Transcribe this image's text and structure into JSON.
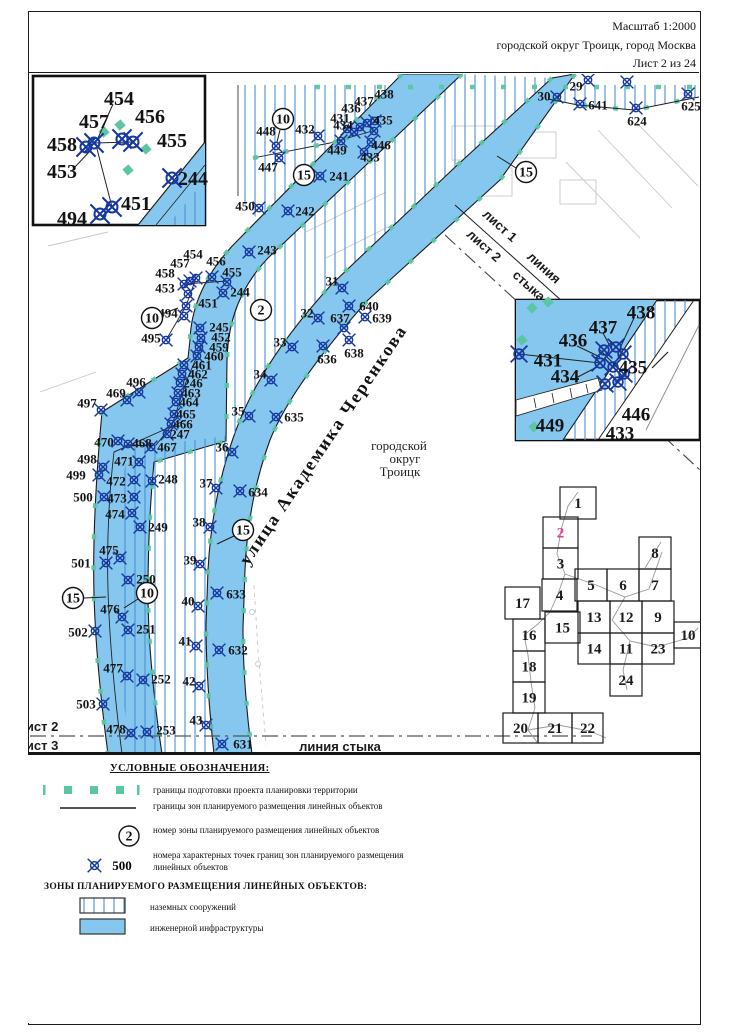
{
  "header": {
    "scale": "Масштаб 1:2000",
    "region": "городской округ Троицк, город Москва",
    "sheet": "Лист 2 из 24"
  },
  "map": {
    "labels": [
      {
        "name": "street-label",
        "t": "улица Академика Черенкова",
        "x": 328,
        "y": 448,
        "rot": -56,
        "cls": "street"
      },
      {
        "name": "city-label-line1",
        "t": "городской",
        "x": 399,
        "y": 450,
        "cls": "city"
      },
      {
        "name": "city-label-line2",
        "t": "округ",
        "x": 405,
        "y": 463,
        "cls": "city"
      },
      {
        "name": "city-label-line3",
        "t": "Троицк",
        "x": 400,
        "y": 476,
        "cls": "city"
      },
      {
        "name": "join-top-sheet1",
        "t": "лист 1",
        "x": 497,
        "y": 229,
        "rot": 42,
        "cls": "join"
      },
      {
        "name": "join-top-sheet2",
        "t": "лист 2",
        "x": 481,
        "y": 249,
        "rot": 42,
        "cls": "join"
      },
      {
        "name": "join-top-word1",
        "t": "линия",
        "x": 541,
        "y": 271,
        "rot": 42,
        "cls": "join"
      },
      {
        "name": "join-top-word2",
        "t": "стыка",
        "x": 526,
        "y": 289,
        "rot": 42,
        "cls": "join"
      },
      {
        "name": "join-bottom-sheet2",
        "t": "лист 2",
        "x": 38,
        "y": 731,
        "cls": "join",
        "anchor": "start"
      },
      {
        "name": "join-bottom-sheet3",
        "t": "лист 3",
        "x": 38,
        "y": 750,
        "cls": "join",
        "anchor": "start"
      },
      {
        "name": "join-bottom-line-label",
        "t": "линия стыка",
        "x": 340,
        "y": 751,
        "cls": "join"
      },
      {
        "name": "ghost-label",
        "t": "3/стр.3",
        "x": 657,
        "y": 394,
        "rot": -50,
        "cls": "ghost"
      }
    ],
    "zone_circles": [
      {
        "n": "10",
        "x": 283,
        "y": 119,
        "leader": [
          280,
          130,
          277,
          142
        ]
      },
      {
        "n": "15",
        "x": 304,
        "y": 175
      },
      {
        "n": "15",
        "x": 526,
        "y": 172,
        "leader": [
          516,
          168,
          497,
          156
        ]
      },
      {
        "n": "2",
        "x": 261,
        "y": 310
      },
      {
        "n": "10",
        "x": 152,
        "y": 318,
        "leader": [
          162,
          314,
          178,
          308
        ]
      },
      {
        "n": "15",
        "x": 243,
        "y": 530,
        "leader": [
          234,
          536,
          217,
          544
        ]
      },
      {
        "n": "10",
        "x": 147,
        "y": 593,
        "leader": [
          138,
          599,
          124,
          608
        ]
      },
      {
        "n": "15",
        "x": 73,
        "y": 598,
        "leader": [
          84,
          598,
          106,
          597
        ]
      }
    ],
    "points": [
      {
        "n": "448",
        "mx": 276,
        "my": 146,
        "lx": 266,
        "ly": 131
      },
      {
        "n": "447",
        "mx": 279,
        "my": 158,
        "lx": 268,
        "ly": 167
      },
      {
        "n": "432",
        "mx": 318,
        "my": 136,
        "lx": 305,
        "ly": 129
      },
      {
        "n": "431",
        "mx": 347,
        "my": 129,
        "lx": 340,
        "ly": 118
      },
      {
        "n": "436",
        "mx": 360,
        "my": 127,
        "lx": 351,
        "ly": 108
      },
      {
        "n": "437",
        "mx": 367,
        "my": 123,
        "lx": 364,
        "ly": 101
      },
      {
        "n": "438",
        "mx": 375,
        "my": 121,
        "lx": 384,
        "ly": 94
      },
      {
        "n": "434",
        "mx": 354,
        "my": 132,
        "lx": 343,
        "ly": 125
      },
      {
        "n": "435",
        "mx": 374,
        "my": 131,
        "lx": 383,
        "ly": 120
      },
      {
        "n": "449",
        "mx": 341,
        "my": 141,
        "lx": 337,
        "ly": 150
      },
      {
        "n": "446",
        "mx": 371,
        "my": 142,
        "lx": 381,
        "ly": 145
      },
      {
        "n": "433",
        "mx": 364,
        "my": 152,
        "lx": 370,
        "ly": 157
      },
      {
        "n": "241",
        "mx": 320,
        "my": 176,
        "lx": 339,
        "ly": 176
      },
      {
        "n": "450",
        "mx": 259,
        "my": 208,
        "lx": 245,
        "ly": 206
      },
      {
        "n": "242",
        "mx": 288,
        "my": 211,
        "lx": 305,
        "ly": 211
      },
      {
        "n": "243",
        "mx": 249,
        "my": 252,
        "lx": 267,
        "ly": 250
      },
      {
        "n": "244",
        "mx": 223,
        "my": 293,
        "lx": 240,
        "ly": 292
      },
      {
        "n": "454",
        "mx": 196,
        "my": 278,
        "lx": 193,
        "ly": 254
      },
      {
        "n": "457",
        "mx": 190,
        "my": 281,
        "lx": 180,
        "ly": 263
      },
      {
        "n": "456",
        "mx": 212,
        "my": 277,
        "lx": 216,
        "ly": 261
      },
      {
        "n": "458",
        "mx": 184,
        "my": 284,
        "lx": 165,
        "ly": 273
      },
      {
        "n": "455",
        "mx": 227,
        "my": 282,
        "lx": 232,
        "ly": 272
      },
      {
        "n": "453",
        "mx": 188,
        "my": 294,
        "lx": 165,
        "ly": 288
      },
      {
        "n": "451",
        "mx": 186,
        "my": 306,
        "lx": 208,
        "ly": 303
      },
      {
        "n": "494",
        "mx": 184,
        "my": 316,
        "lx": 168,
        "ly": 313
      },
      {
        "n": "495",
        "mx": 166,
        "my": 340,
        "lx": 151,
        "ly": 338
      },
      {
        "n": "245",
        "mx": 200,
        "my": 328,
        "lx": 219,
        "ly": 327
      },
      {
        "n": "452",
        "mx": 201,
        "my": 338,
        "lx": 221,
        "ly": 337
      },
      {
        "n": "459",
        "mx": 199,
        "my": 347,
        "lx": 219,
        "ly": 347
      },
      {
        "n": "460",
        "mx": 197,
        "my": 356,
        "lx": 214,
        "ly": 356
      },
      {
        "n": "461",
        "mx": 184,
        "my": 365,
        "lx": 202,
        "ly": 365
      },
      {
        "n": "462",
        "mx": 182,
        "my": 374,
        "lx": 198,
        "ly": 374
      },
      {
        "n": "246",
        "mx": 180,
        "my": 383,
        "lx": 193,
        "ly": 383
      },
      {
        "n": "463",
        "mx": 178,
        "my": 393,
        "lx": 191,
        "ly": 393
      },
      {
        "n": "464",
        "mx": 176,
        "my": 402,
        "lx": 189,
        "ly": 402
      },
      {
        "n": "465",
        "mx": 174,
        "my": 414,
        "lx": 186,
        "ly": 414
      },
      {
        "n": "466",
        "mx": 171,
        "my": 424,
        "lx": 183,
        "ly": 424
      },
      {
        "n": "247",
        "mx": 167,
        "my": 434,
        "lx": 180,
        "ly": 434
      },
      {
        "n": "467",
        "mx": 151,
        "my": 447,
        "lx": 167,
        "ly": 447
      },
      {
        "n": "468",
        "mx": 128,
        "my": 444,
        "lx": 142,
        "ly": 443
      },
      {
        "n": "470",
        "mx": 118,
        "my": 441,
        "lx": 104,
        "ly": 442
      },
      {
        "n": "496",
        "mx": 139,
        "my": 392,
        "lx": 136,
        "ly": 382
      },
      {
        "n": "469",
        "mx": 127,
        "my": 400,
        "lx": 116,
        "ly": 393
      },
      {
        "n": "497",
        "mx": 101,
        "my": 410,
        "lx": 87,
        "ly": 403
      },
      {
        "n": "498",
        "mx": 103,
        "my": 467,
        "lx": 87,
        "ly": 459
      },
      {
        "n": "471",
        "mx": 139,
        "my": 462,
        "lx": 124,
        "ly": 461
      },
      {
        "n": "499",
        "mx": 99,
        "my": 475,
        "lx": 76,
        "ly": 475
      },
      {
        "n": "472",
        "mx": 134,
        "my": 480,
        "lx": 116,
        "ly": 481
      },
      {
        "n": "248",
        "mx": 152,
        "my": 481,
        "lx": 168,
        "ly": 479
      },
      {
        "n": "500",
        "mx": 104,
        "my": 497,
        "lx": 83,
        "ly": 497
      },
      {
        "n": "473",
        "mx": 134,
        "my": 497,
        "lx": 117,
        "ly": 498
      },
      {
        "n": "474",
        "mx": 132,
        "my": 513,
        "lx": 115,
        "ly": 514
      },
      {
        "n": "249",
        "mx": 140,
        "my": 527,
        "lx": 158,
        "ly": 527
      },
      {
        "n": "501",
        "mx": 106,
        "my": 563,
        "lx": 81,
        "ly": 563
      },
      {
        "n": "475",
        "mx": 120,
        "my": 558,
        "lx": 109,
        "ly": 550
      },
      {
        "n": "250",
        "mx": 128,
        "my": 580,
        "lx": 146,
        "ly": 579
      },
      {
        "n": "476",
        "mx": 122,
        "my": 617,
        "lx": 110,
        "ly": 609
      },
      {
        "n": "502",
        "mx": 95,
        "my": 631,
        "lx": 78,
        "ly": 632
      },
      {
        "n": "251",
        "mx": 128,
        "my": 630,
        "lx": 146,
        "ly": 629
      },
      {
        "n": "477",
        "mx": 127,
        "my": 676,
        "lx": 113,
        "ly": 668
      },
      {
        "n": "252",
        "mx": 143,
        "my": 680,
        "lx": 161,
        "ly": 679
      },
      {
        "n": "503",
        "mx": 103,
        "my": 704,
        "lx": 86,
        "ly": 704
      },
      {
        "n": "478",
        "mx": 131,
        "my": 733,
        "lx": 116,
        "ly": 729
      },
      {
        "n": "253",
        "mx": 147,
        "my": 732,
        "lx": 166,
        "ly": 730
      },
      {
        "n": "31",
        "mx": 342,
        "my": 288,
        "lx": 332,
        "ly": 281
      },
      {
        "n": "32",
        "mx": 318,
        "my": 318,
        "lx": 307,
        "ly": 313
      },
      {
        "n": "33",
        "mx": 292,
        "my": 347,
        "lx": 280,
        "ly": 342
      },
      {
        "n": "34",
        "mx": 271,
        "my": 380,
        "lx": 260,
        "ly": 374
      },
      {
        "n": "35",
        "mx": 249,
        "my": 416,
        "lx": 238,
        "ly": 411
      },
      {
        "n": "36",
        "mx": 232,
        "my": 452,
        "lx": 222,
        "ly": 447
      },
      {
        "n": "37",
        "mx": 216,
        "my": 488,
        "lx": 206,
        "ly": 483
      },
      {
        "n": "38",
        "mx": 210,
        "my": 527,
        "lx": 199,
        "ly": 522
      },
      {
        "n": "39",
        "mx": 200,
        "my": 564,
        "lx": 190,
        "ly": 560
      },
      {
        "n": "40",
        "mx": 198,
        "my": 606,
        "lx": 188,
        "ly": 601
      },
      {
        "n": "41",
        "mx": 196,
        "my": 646,
        "lx": 185,
        "ly": 641
      },
      {
        "n": "42",
        "mx": 199,
        "my": 686,
        "lx": 189,
        "ly": 681
      },
      {
        "n": "43",
        "mx": 206,
        "my": 725,
        "lx": 196,
        "ly": 720
      },
      {
        "n": "640",
        "mx": 349,
        "my": 306,
        "lx": 369,
        "ly": 306
      },
      {
        "n": "639",
        "mx": 365,
        "my": 317,
        "lx": 382,
        "ly": 318
      },
      {
        "n": "637",
        "mx": 344,
        "my": 328,
        "lx": 340,
        "ly": 318
      },
      {
        "n": "638",
        "mx": 349,
        "my": 340,
        "lx": 354,
        "ly": 353
      },
      {
        "n": "636",
        "mx": 323,
        "my": 346,
        "lx": 327,
        "ly": 359
      },
      {
        "n": "635",
        "mx": 276,
        "my": 417,
        "lx": 294,
        "ly": 417
      },
      {
        "n": "634",
        "mx": 240,
        "my": 491,
        "lx": 258,
        "ly": 492
      },
      {
        "n": "633",
        "mx": 217,
        "my": 593,
        "lx": 236,
        "ly": 594
      },
      {
        "n": "632",
        "mx": 219,
        "my": 650,
        "lx": 238,
        "ly": 650
      },
      {
        "n": "631",
        "mx": 222,
        "my": 744,
        "lx": 243,
        "ly": 744
      },
      {
        "n": "29",
        "mx": 588,
        "my": 80,
        "lx": 576,
        "ly": 86
      },
      {
        "n": "30",
        "mx": 557,
        "my": 97,
        "lx": 544,
        "ly": 96
      },
      {
        "n": "641",
        "mx": 580,
        "my": 104,
        "lx": 598,
        "ly": 105
      },
      {
        "n": "624",
        "mx": 636,
        "my": 108,
        "lx": 637,
        "ly": 121
      },
      {
        "n": "625",
        "mx": 688,
        "my": 94,
        "lx": 691,
        "ly": 106
      }
    ],
    "extra_markers": [
      [
        627,
        82
      ]
    ],
    "inset1": {
      "labels": [
        {
          "n": "454",
          "x": 119,
          "y": 98
        },
        {
          "n": "457",
          "x": 94,
          "y": 121
        },
        {
          "n": "456",
          "x": 150,
          "y": 116
        },
        {
          "n": "458",
          "x": 62,
          "y": 144
        },
        {
          "n": "455",
          "x": 172,
          "y": 140
        },
        {
          "n": "453",
          "x": 62,
          "y": 171
        },
        {
          "n": "244",
          "x": 193,
          "y": 178
        },
        {
          "n": "451",
          "x": 136,
          "y": 203
        },
        {
          "n": "494",
          "x": 72,
          "y": 218
        }
      ],
      "markers": [
        [
          94,
          143
        ],
        [
          86,
          147
        ],
        [
          122,
          139
        ],
        [
          133,
          142
        ],
        [
          172,
          178
        ],
        [
          112,
          207
        ],
        [
          100,
          214
        ]
      ]
    },
    "inset2": {
      "labels": [
        {
          "n": "438",
          "x": 641,
          "y": 312
        },
        {
          "n": "437",
          "x": 603,
          "y": 327
        },
        {
          "n": "436",
          "x": 573,
          "y": 340
        },
        {
          "n": "431",
          "x": 548,
          "y": 360
        },
        {
          "n": "434",
          "x": 565,
          "y": 376
        },
        {
          "n": "435",
          "x": 633,
          "y": 367
        },
        {
          "n": "446",
          "x": 636,
          "y": 414
        },
        {
          "n": "449",
          "x": 550,
          "y": 425
        },
        {
          "n": "433",
          "x": 620,
          "y": 433
        }
      ],
      "markers": [
        [
          604,
          350
        ],
        [
          616,
          347
        ],
        [
          623,
          354
        ],
        [
          600,
          363
        ],
        [
          613,
          367
        ],
        [
          624,
          374
        ],
        [
          605,
          384
        ],
        [
          618,
          382
        ],
        [
          519,
          354
        ]
      ]
    },
    "index": {
      "cells": [
        {
          "n": "1",
          "x": 560,
          "y": 487,
          "w": 36,
          "h": 32
        },
        {
          "n": "2",
          "x": 543,
          "y": 517,
          "w": 35,
          "h": 31,
          "cur": true
        },
        {
          "n": "3",
          "x": 543,
          "y": 548,
          "w": 35,
          "h": 31
        },
        {
          "n": "4",
          "x": 542,
          "y": 579,
          "w": 35,
          "h": 32
        },
        {
          "n": "5",
          "x": 575,
          "y": 569,
          "w": 32,
          "h": 32
        },
        {
          "n": "6",
          "x": 607,
          "y": 569,
          "w": 32,
          "h": 32
        },
        {
          "n": "8",
          "x": 639,
          "y": 537,
          "w": 32,
          "h": 32
        },
        {
          "n": "7",
          "x": 639,
          "y": 569,
          "w": 32,
          "h": 32
        },
        {
          "n": "17",
          "x": 505,
          "y": 587,
          "w": 35,
          "h": 32
        },
        {
          "n": "15",
          "x": 545,
          "y": 612,
          "w": 35,
          "h": 31
        },
        {
          "n": "13",
          "x": 578,
          "y": 601,
          "w": 32,
          "h": 32
        },
        {
          "n": "12",
          "x": 610,
          "y": 601,
          "w": 32,
          "h": 32
        },
        {
          "n": "9",
          "x": 642,
          "y": 601,
          "w": 32,
          "h": 32
        },
        {
          "n": "16",
          "x": 513,
          "y": 619,
          "w": 32,
          "h": 32
        },
        {
          "n": "10",
          "x": 674,
          "y": 622,
          "w": 28,
          "h": 26
        },
        {
          "n": "14",
          "x": 578,
          "y": 633,
          "w": 32,
          "h": 31
        },
        {
          "n": "11",
          "x": 610,
          "y": 633,
          "w": 32,
          "h": 31
        },
        {
          "n": "23",
          "x": 642,
          "y": 633,
          "w": 32,
          "h": 31
        },
        {
          "n": "18",
          "x": 513,
          "y": 651,
          "w": 32,
          "h": 31
        },
        {
          "n": "24",
          "x": 610,
          "y": 664,
          "w": 32,
          "h": 32
        },
        {
          "n": "19",
          "x": 513,
          "y": 682,
          "w": 32,
          "h": 31
        },
        {
          "n": "20",
          "x": 503,
          "y": 713,
          "w": 35,
          "h": 30
        },
        {
          "n": "21",
          "x": 538,
          "y": 713,
          "w": 34,
          "h": 30
        },
        {
          "n": "22",
          "x": 572,
          "y": 713,
          "w": 31,
          "h": 30
        }
      ]
    }
  },
  "legend": {
    "title": "УСЛОВНЫЕ ОБОЗНАЧЕНИЯ:",
    "items": [
      {
        "label": "границы подготовки проекта планировки территории"
      },
      {
        "label": "границы зон планируемого размещения линейных объектов"
      },
      {
        "label": "номер зоны планируемого размещения линейных объектов",
        "symbol": "2"
      },
      {
        "label": "номера характерных точек границ зон планируемого размещения линейных объектов",
        "symbol": "500"
      }
    ],
    "zones_title": "ЗОНЫ ПЛАНИРУЕМОГО РАЗМЕЩЕНИЯ ЛИНЕЙНЫХ ОБЪЕКТОВ:",
    "zone_items": [
      {
        "label": "наземных сооружений"
      },
      {
        "label": "инженерной инфраструктуры"
      }
    ],
    "colors": {
      "zone_fill": "#86c7ef",
      "hatch_line": "#4a90d2",
      "boundary_green": "#5bc6a4",
      "marker_navy": "#16389e",
      "current_sheet_pink": "#e2418f"
    }
  }
}
